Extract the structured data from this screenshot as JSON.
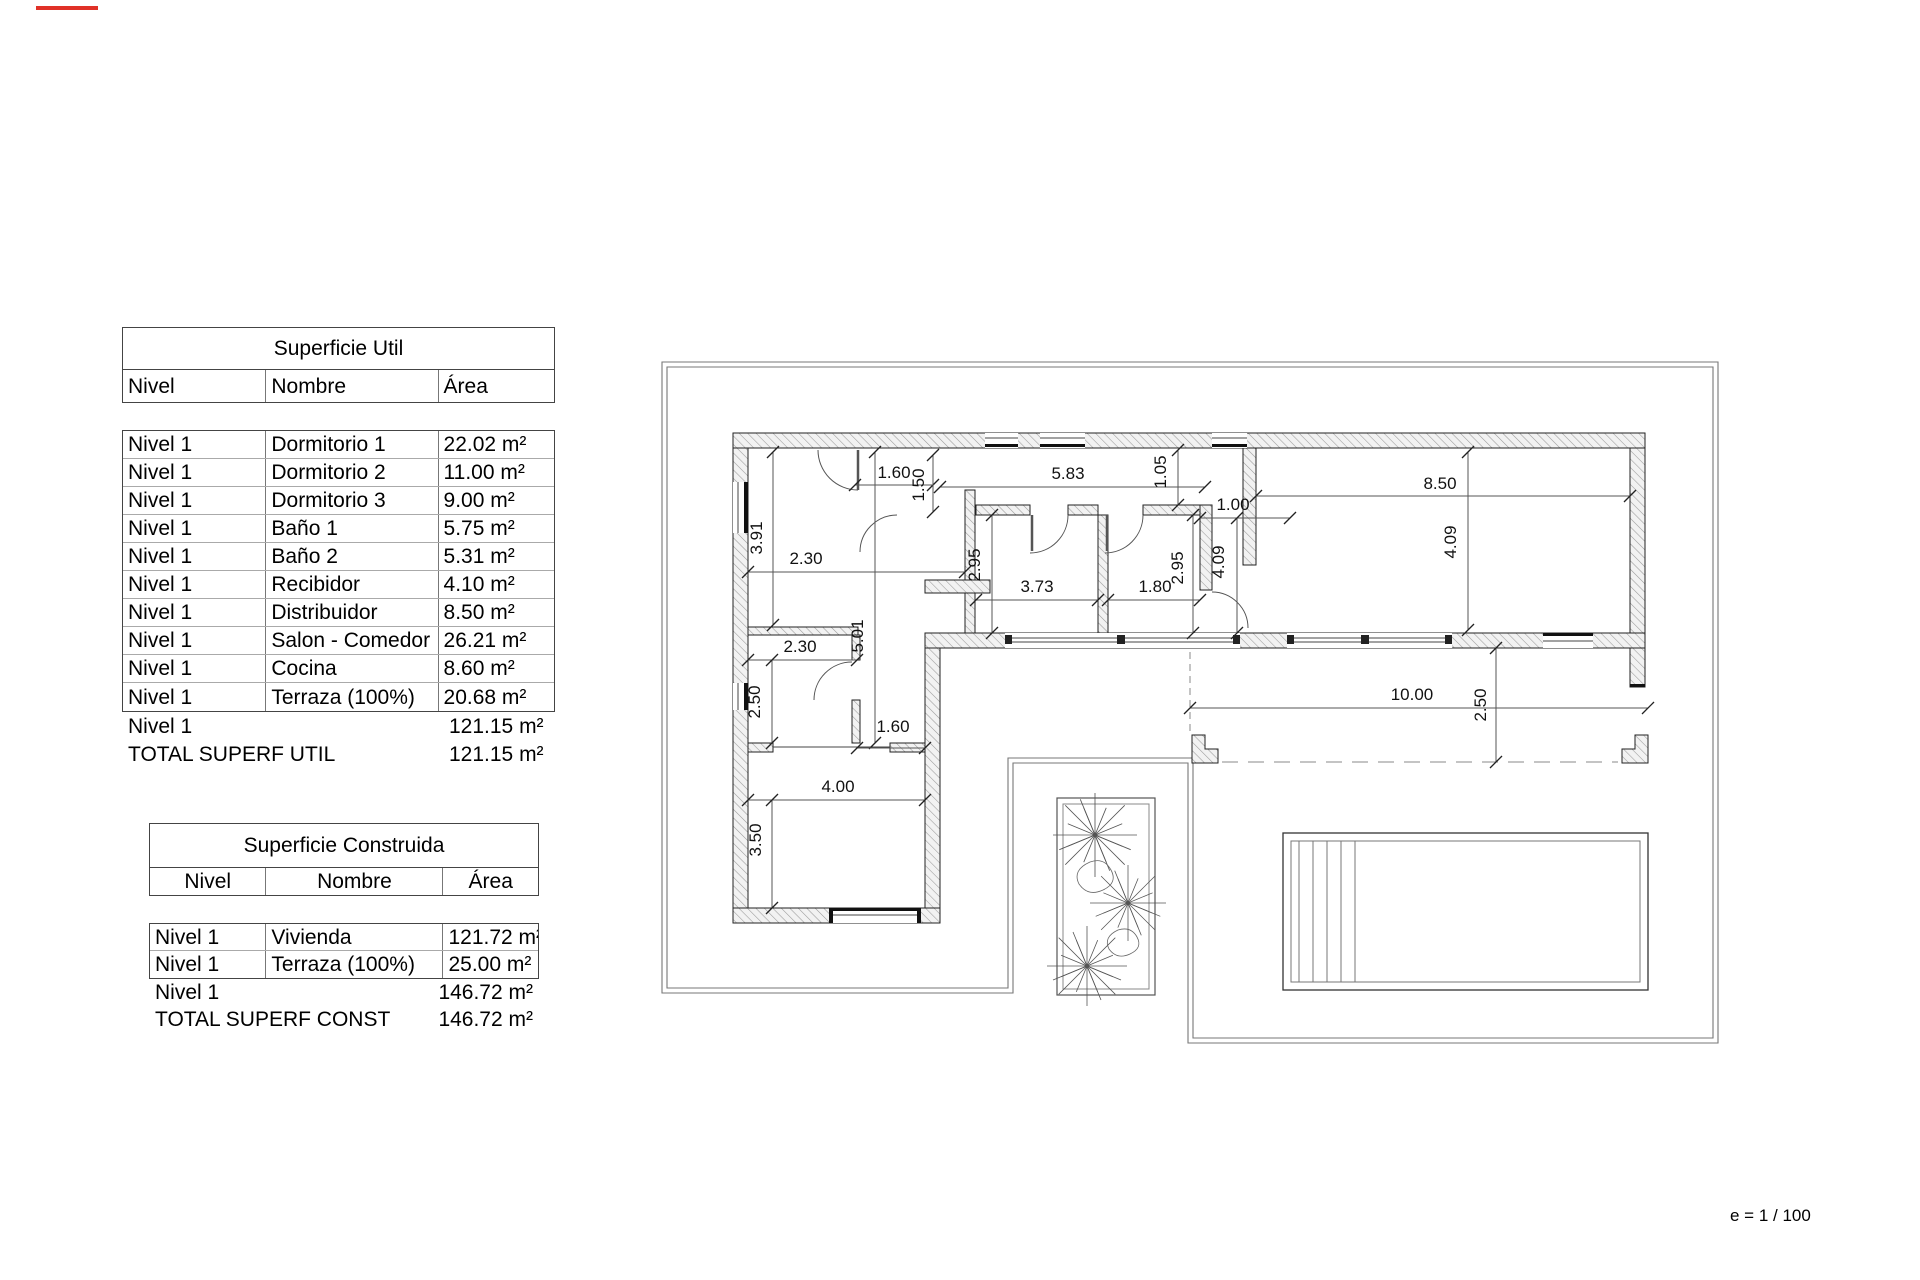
{
  "page": {
    "scale_note": "e = 1 / 100"
  },
  "tables": {
    "superficie_util": {
      "title": "Superficie Util",
      "headers": [
        "Nivel",
        "Nombre",
        "Área"
      ],
      "rows": [
        [
          "Nivel 1",
          "Dormitorio 1",
          "22.02 m²"
        ],
        [
          "Nivel 1",
          "Dormitorio 2",
          "11.00 m²"
        ],
        [
          "Nivel 1",
          "Dormitorio 3",
          "9.00 m²"
        ],
        [
          "Nivel 1",
          "Baño 1",
          "5.75 m²"
        ],
        [
          "Nivel 1",
          "Baño 2",
          "5.31 m²"
        ],
        [
          "Nivel 1",
          "Recibidor",
          "4.10 m²"
        ],
        [
          "Nivel 1",
          "Distribuidor",
          "8.50 m²"
        ],
        [
          "Nivel 1",
          "Salon - Comedor",
          "26.21 m²"
        ],
        [
          "Nivel 1",
          "Cocina",
          "8.60 m²"
        ],
        [
          "Nivel 1",
          "Terraza (100%)",
          "20.68 m²"
        ]
      ],
      "subtotal": {
        "label": "Nivel 1",
        "value": "121.15 m²"
      },
      "total": {
        "label": "TOTAL SUPERF UTIL",
        "value": "121.15 m²"
      }
    },
    "superficie_construida": {
      "title": "Superficie Construida",
      "headers": [
        "Nivel",
        "Nombre",
        "Área"
      ],
      "rows": [
        [
          "Nivel 1",
          "Vivienda",
          "121.72 m²"
        ],
        [
          "Nivel 1",
          "Terraza (100%)",
          "25.00 m²"
        ]
      ],
      "subtotal": {
        "label": "Nivel 1",
        "value": "146.72 m²"
      },
      "total": {
        "label": "TOTAL SUPERF CONST",
        "value": "146.72 m²"
      }
    }
  },
  "plan": {
    "dims": [
      {
        "t": "1.60",
        "x": 894,
        "y": 478,
        "r": 0,
        "l": [
          855,
          485,
          933,
          485
        ]
      },
      {
        "t": "1.50",
        "x": 924,
        "y": 485,
        "r": 1,
        "l": [
          933,
          455,
          933,
          512
        ]
      },
      {
        "t": "3.91",
        "x": 762,
        "y": 538,
        "r": 1,
        "l": [
          773,
          452,
          773,
          625
        ]
      },
      {
        "t": "2.30",
        "x": 806,
        "y": 564,
        "r": 0,
        "l": [
          748,
          572,
          965,
          572
        ]
      },
      {
        "t": "5.83",
        "x": 1068,
        "y": 479,
        "r": 0,
        "l": [
          940,
          487,
          1205,
          487
        ]
      },
      {
        "t": "1.05",
        "x": 1166,
        "y": 472,
        "r": 1,
        "l": [
          1178,
          450,
          1178,
          505
        ]
      },
      {
        "t": "1.00",
        "x": 1233,
        "y": 510,
        "r": 0,
        "l": [
          1200,
          518,
          1290,
          518
        ]
      },
      {
        "t": "4.09",
        "x": 1224,
        "y": 562,
        "r": 1,
        "l": [
          1237,
          518,
          1237,
          633
        ]
      },
      {
        "t": "2.95",
        "x": 980,
        "y": 565,
        "r": 1,
        "l": [
          992,
          515,
          992,
          633
        ]
      },
      {
        "t": "3.73",
        "x": 1037,
        "y": 592,
        "r": 0,
        "l": [
          976,
          600,
          1098,
          600
        ]
      },
      {
        "t": "1.80",
        "x": 1155,
        "y": 592,
        "r": 0,
        "l": [
          1108,
          600,
          1200,
          600
        ]
      },
      {
        "t": "2.95",
        "x": 1183,
        "y": 568,
        "r": 1,
        "l": [
          1193,
          515,
          1193,
          633
        ]
      },
      {
        "t": "8.50",
        "x": 1440,
        "y": 489,
        "r": 0,
        "l": [
          1256,
          496,
          1630,
          496
        ]
      },
      {
        "t": "4.09",
        "x": 1456,
        "y": 542,
        "r": 1,
        "l": [
          1468,
          452,
          1468,
          630
        ]
      },
      {
        "t": "5.01",
        "x": 863,
        "y": 636,
        "r": 1,
        "l": [
          875,
          452,
          875,
          743
        ]
      },
      {
        "t": "2.30",
        "x": 800,
        "y": 652,
        "r": 0,
        "l": [
          748,
          660,
          857,
          660
        ]
      },
      {
        "t": "2.50",
        "x": 760,
        "y": 702,
        "r": 1,
        "l": [
          772,
          660,
          772,
          743
        ]
      },
      {
        "t": "1.60",
        "x": 893,
        "y": 732,
        "r": 0,
        "l": [
          857,
          748,
          925,
          748
        ]
      },
      {
        "t": "4.00",
        "x": 838,
        "y": 792,
        "r": 0,
        "l": [
          748,
          800,
          925,
          800
        ]
      },
      {
        "t": "3.50",
        "x": 761,
        "y": 840,
        "r": 1,
        "l": [
          772,
          800,
          772,
          908
        ]
      },
      {
        "t": "10.00",
        "x": 1412,
        "y": 700,
        "r": 0,
        "l": [
          1190,
          708,
          1648,
          708
        ]
      },
      {
        "t": "2.50",
        "x": 1486,
        "y": 705,
        "r": 1,
        "l": [
          1496,
          648,
          1496,
          762
        ]
      }
    ]
  }
}
